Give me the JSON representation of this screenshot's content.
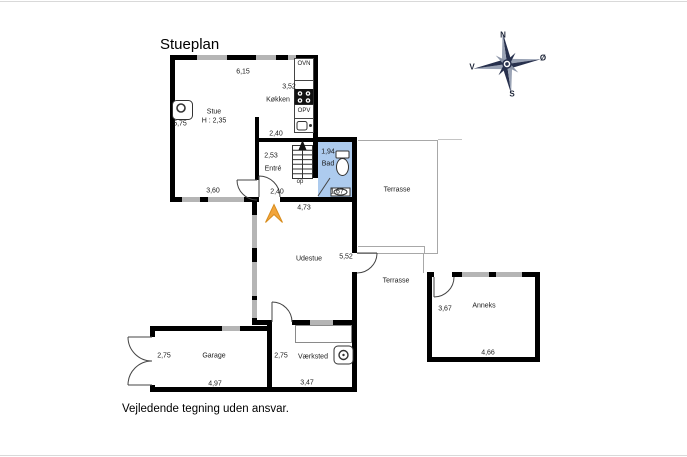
{
  "title": "Stueplan",
  "footer": "Vejledende tegning uden ansvar.",
  "compass": {
    "north": "N",
    "east": "Ø",
    "south": "S",
    "west": "V"
  },
  "labels": {
    "stue": "Stue",
    "stue_height": "H : 2,35",
    "koekken": "Køkken",
    "entre": "Entré",
    "bad": "Bad",
    "udestue": "Udestue",
    "terrasse_upper": "Terrasse",
    "terrasse_lower": "Terrasse",
    "anneks": "Anneks",
    "garage": "Garage",
    "vaerksted": "Værksted",
    "ovn": "OVN",
    "opv": "OPV",
    "op": "op"
  },
  "measurements": {
    "stue_width": "6,15",
    "koekken_depth": "3,52",
    "stue_depth": "5,75",
    "koekken_width": "2,40",
    "entre_depth": "2,53",
    "bad_width": "1,94",
    "stue_bottom": "3,60",
    "entre_width": "2,40",
    "bad_depth": "1,67",
    "house_bottom": "4,73",
    "udestue_depth": "5,52",
    "anneks_depth": "3,67",
    "anneks_width": "4,66",
    "garage_depth": "2,75",
    "garage_width": "4,97",
    "vaerksted_depth": "2,75",
    "vaerksted_width": "3,47"
  },
  "colors": {
    "wall": "#000000",
    "window_marker": "#b5b5b5",
    "bathroom_fill": "#adcbee",
    "terrace_outline": "#a8a8a8",
    "entrance_arrow": "#f2a53c",
    "compass_dark": "#27304d",
    "compass_light": "#9aa3b5"
  }
}
